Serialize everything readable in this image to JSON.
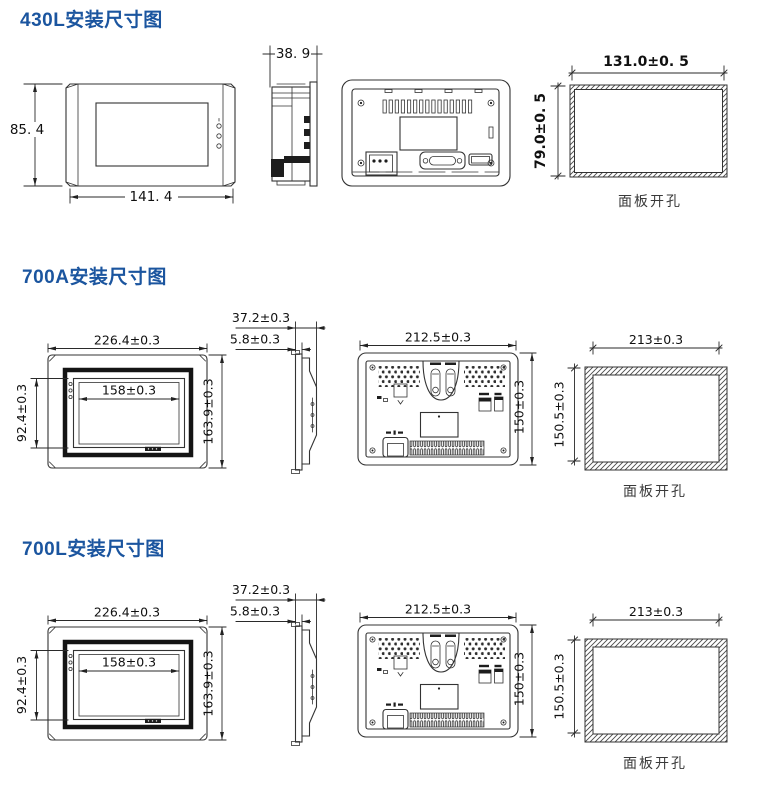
{
  "colors": {
    "title_blue": "#1b559f",
    "drawing_line": "#333333",
    "dimension_text": "#101010"
  },
  "sections": {
    "s430l": {
      "title": "430L安装尺寸图",
      "front": {
        "height": "85. 4",
        "width": "141. 4"
      },
      "side": {
        "depth": "38. 9"
      },
      "cutout": {
        "width": "131.0±0. 5",
        "height": "79.0±0. 5",
        "label": "面板开孔"
      }
    },
    "s700a": {
      "title": "700A安装尺寸图",
      "front": {
        "width": "226.4±0.3",
        "screen_width": "158±0.3",
        "screen_height": "92.4±0.3",
        "height": "163.9±0.3"
      },
      "side": {
        "depth": "37.2±0.3",
        "bezel": "5.8±0.3"
      },
      "rear": {
        "width": "212.5±0.3",
        "height": "150±0.3"
      },
      "cutout": {
        "width": "213±0.3",
        "height": "150.5±0.3",
        "label": "面板开孔"
      }
    },
    "s700l": {
      "title": "700L安装尺寸图",
      "front": {
        "width": "226.4±0.3",
        "screen_width": "158±0.3",
        "screen_height": "92.4±0.3",
        "height": "163.9±0.3"
      },
      "side": {
        "depth": "37.2±0.3",
        "bezel": "5.8±0.3"
      },
      "rear": {
        "width": "212.5±0.3",
        "height": "150±0.3"
      },
      "cutout": {
        "width": "213±0.3",
        "height": "150.5±0.3",
        "label": "面板开孔"
      }
    }
  }
}
